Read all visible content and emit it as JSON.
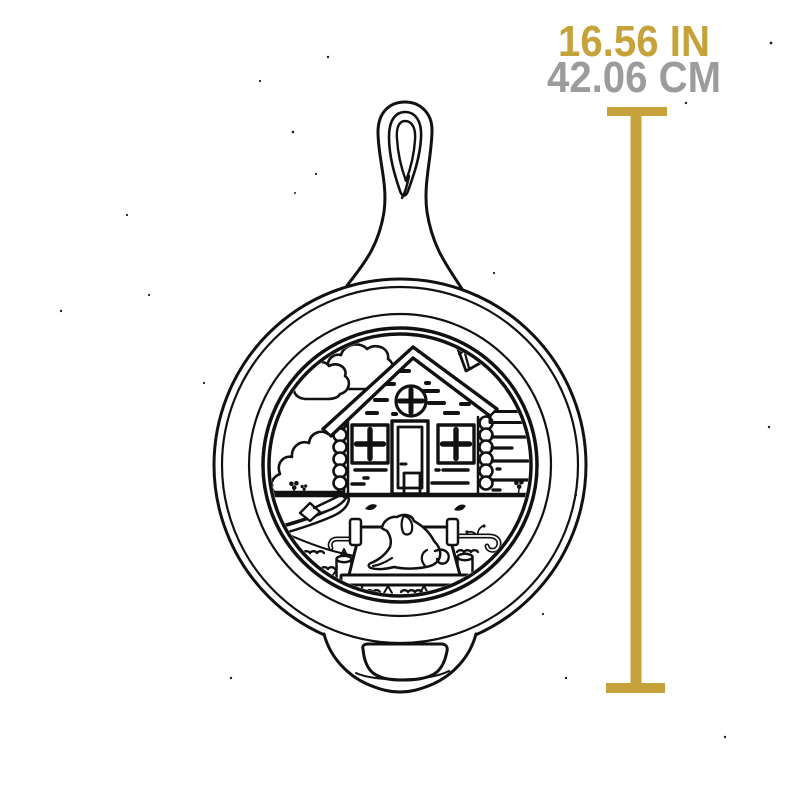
{
  "dimension_annotation": {
    "inches": "16.56 IN",
    "centimeters": "42.06 CM"
  },
  "colors": {
    "accent_gold": "#C5A23A",
    "label_gray": "#9B9C9E",
    "ink": "#111111",
    "background": "#FFFFFF"
  },
  "illustration": {
    "name": "cast-iron-skillet-line-art",
    "scene": "log cabin, clouds, chimney, bush, canoe with paddle, lake dock with resting dog, waves and plants engraved inside skillet"
  }
}
